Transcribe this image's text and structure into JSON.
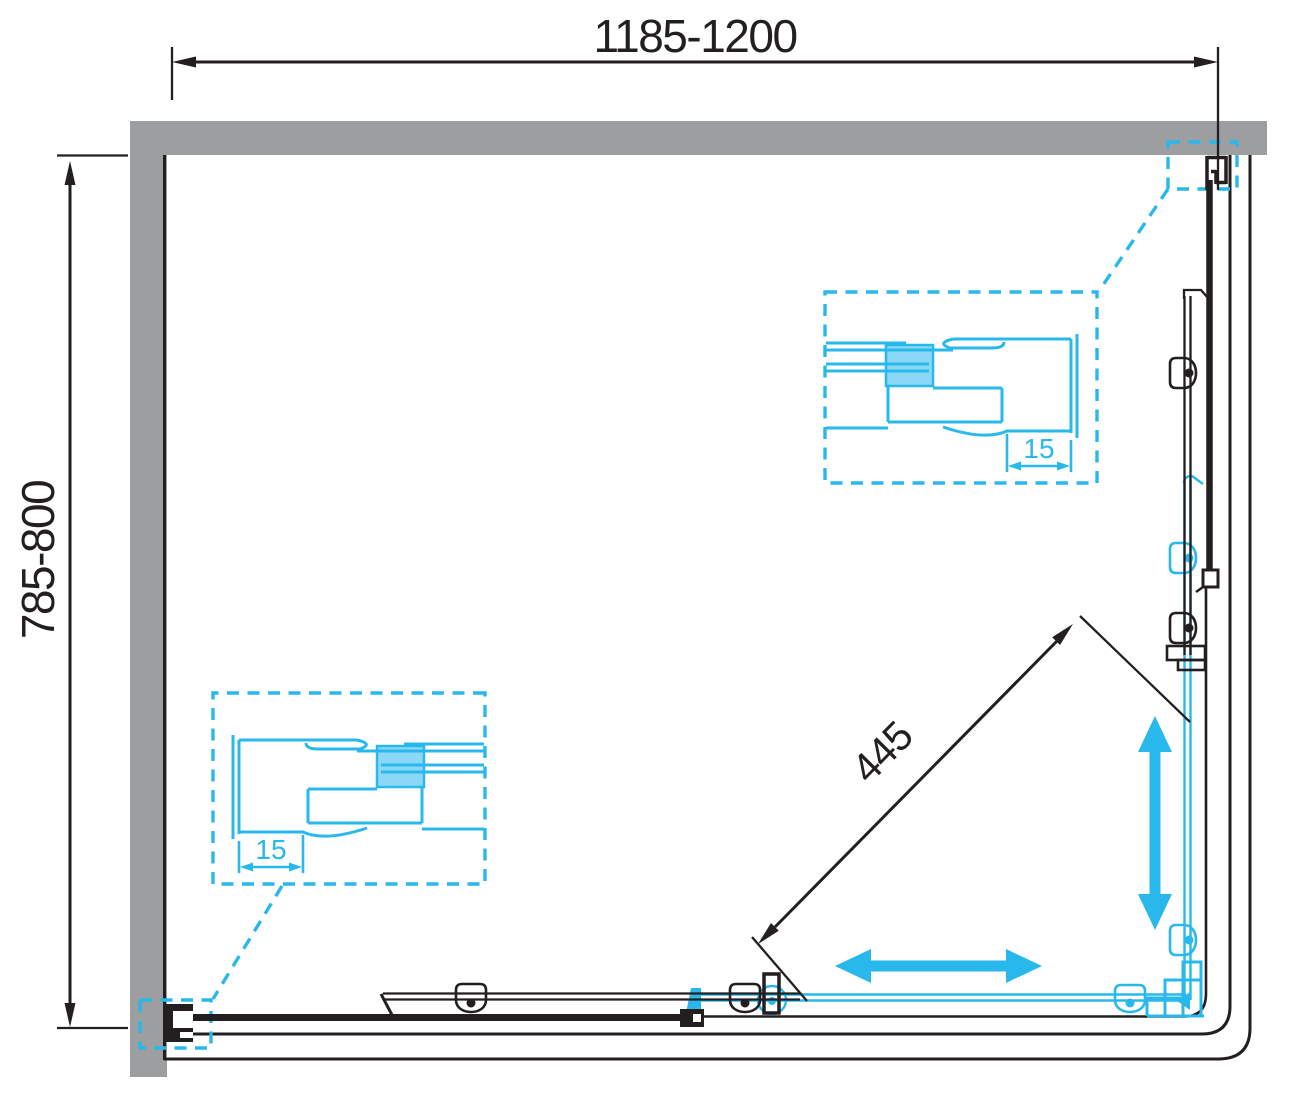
{
  "drawing": {
    "type": "shower-enclosure-plan-view",
    "dimensions": {
      "width": "1185-1200",
      "depth": "785-800",
      "diagonal_opening": "445",
      "detail_offset_top": "15",
      "detail_offset_bottom": "15"
    },
    "colors": {
      "gray": "#9C9E9F",
      "cyan": "#29B8EC",
      "ink": "#231F20",
      "bg": "#FFFFFF"
    }
  }
}
